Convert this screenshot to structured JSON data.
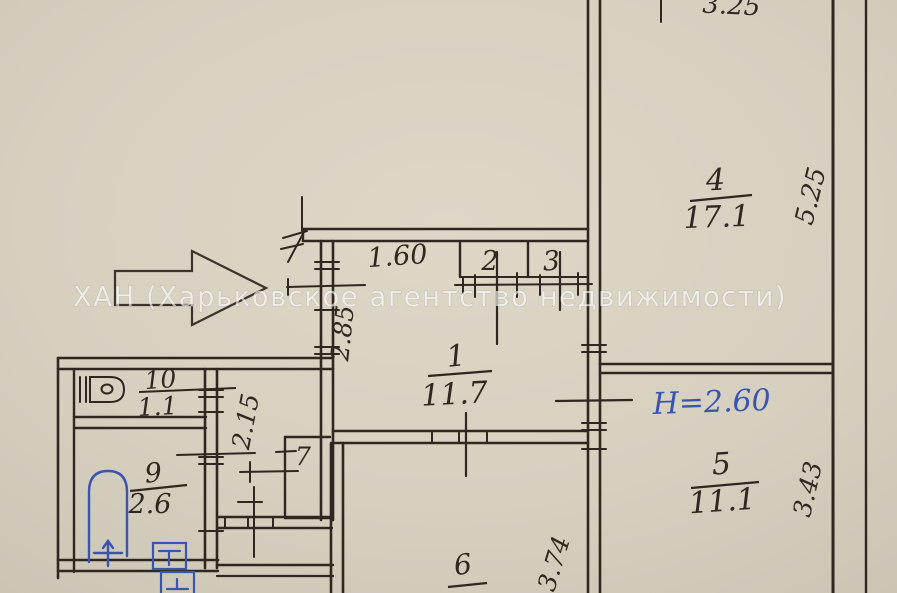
{
  "watermark": "ХАН (Харьковское агентство недвижимости)",
  "annotations": {
    "ceiling_height": "H=2.60"
  },
  "rooms": {
    "r1": {
      "number": "1",
      "area": "11.7"
    },
    "r2": {
      "number": "2"
    },
    "r3": {
      "number": "3"
    },
    "r4": {
      "number": "4",
      "area": "17.1"
    },
    "r5": {
      "number": "5",
      "area": "11.1"
    },
    "r6": {
      "number": "6"
    },
    "r7": {
      "number": "7"
    },
    "r9": {
      "number": "9",
      "area": "2.6"
    },
    "r10": {
      "number": "10",
      "area": "1.1"
    }
  },
  "dimensions": {
    "top_width": "3.25",
    "right_upper": "5.25",
    "hall_top": "1.60",
    "hall_left": "2.85",
    "corridor": "2.15",
    "right_lower": "3.43",
    "bottom": "3.74"
  },
  "icons": {
    "entry_arrow": "entrance-direction-arrow",
    "bathtub": "bathtub-icon",
    "toilet": "toilet-icon",
    "appliance_top": "sink-appliance-icon",
    "appliance_bottom": "washer-appliance-icon"
  },
  "colors": {
    "paper": "#d6d0c1",
    "ink": "#2e2820",
    "blue_ink": "#3b55ae",
    "watermark_fill": "rgba(255,255,255,0.62)"
  }
}
